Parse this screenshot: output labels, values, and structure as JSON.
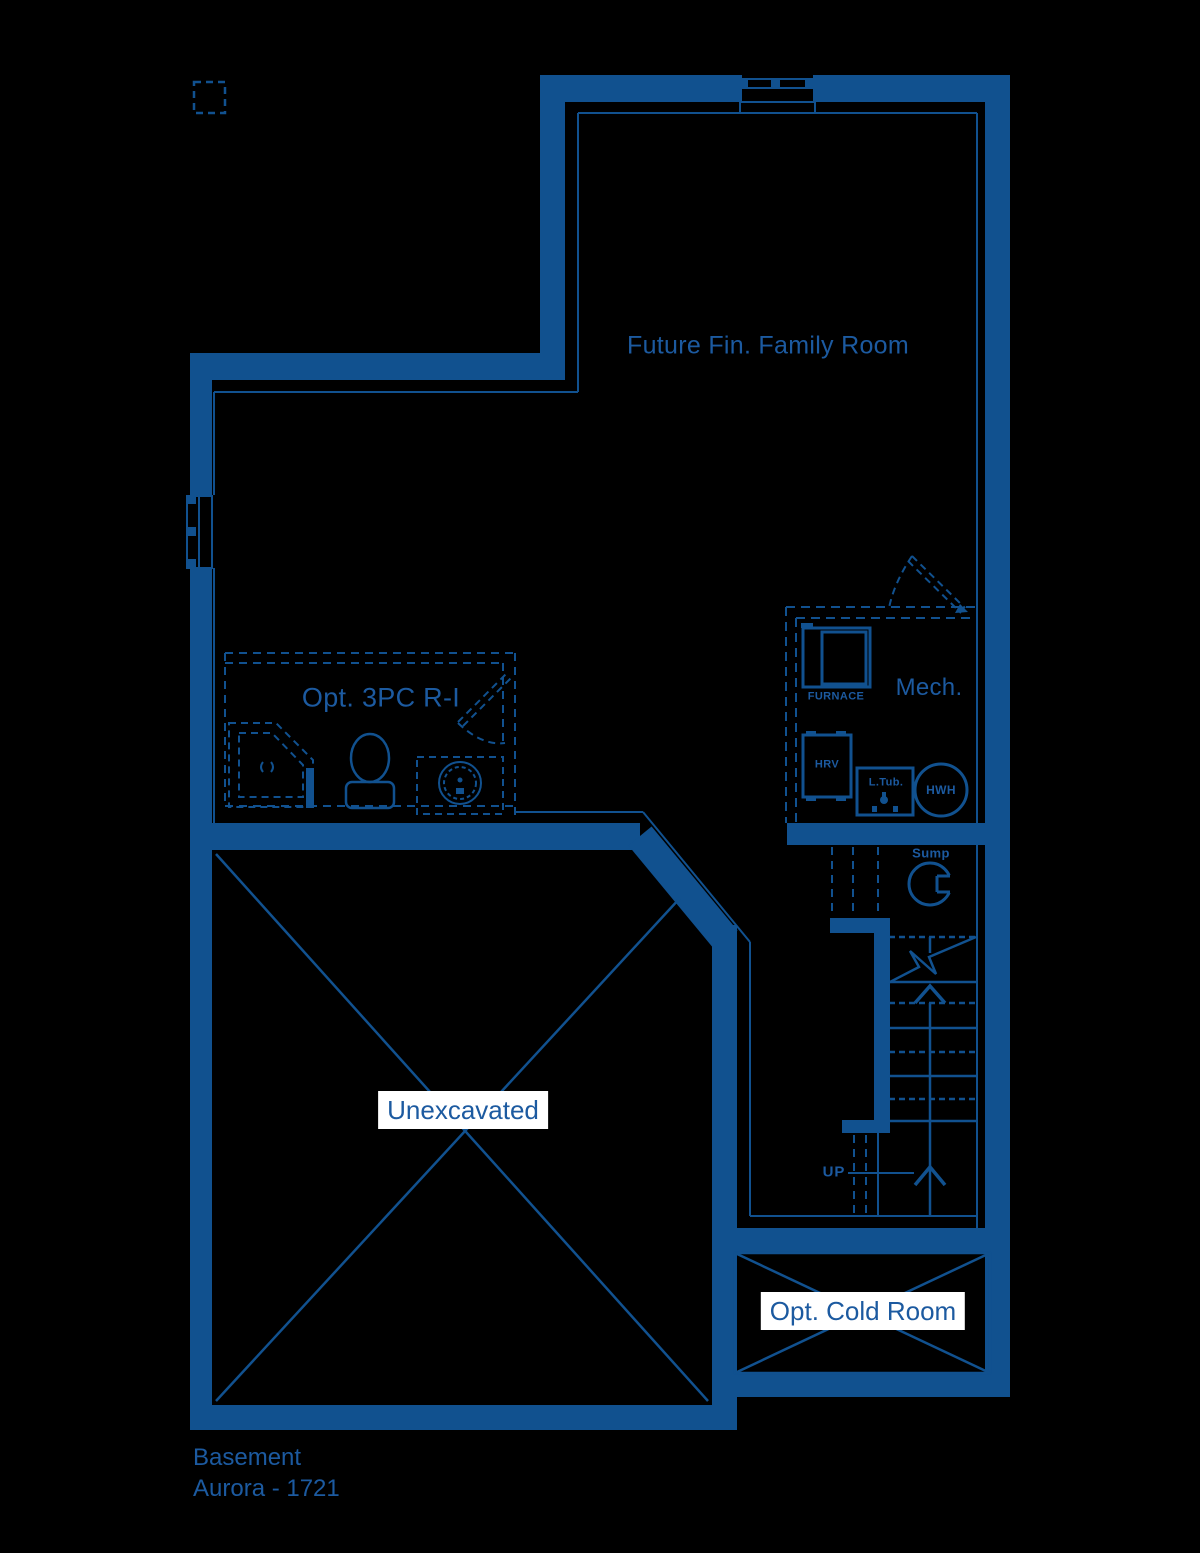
{
  "plan": {
    "name": "Basement",
    "model": "Aurora - 1721"
  },
  "rooms": {
    "family_room": "Future Fin. Family Room",
    "bathroom": "Opt. 3PC R-I",
    "mech": "Mech.",
    "unexcavated": "Unexcavated",
    "cold_room": "Opt. Cold Room"
  },
  "equipment": {
    "furnace": "FURNACE",
    "hrv": "HRV",
    "laundry_tub": "L.Tub.",
    "water_heater": "HWH",
    "sump": "Sump"
  },
  "stairs": {
    "direction": "UP"
  },
  "colors": {
    "wall": "#11518f",
    "text": "#1c5aa0",
    "background": "#000000",
    "label_background": "#ffffff"
  }
}
